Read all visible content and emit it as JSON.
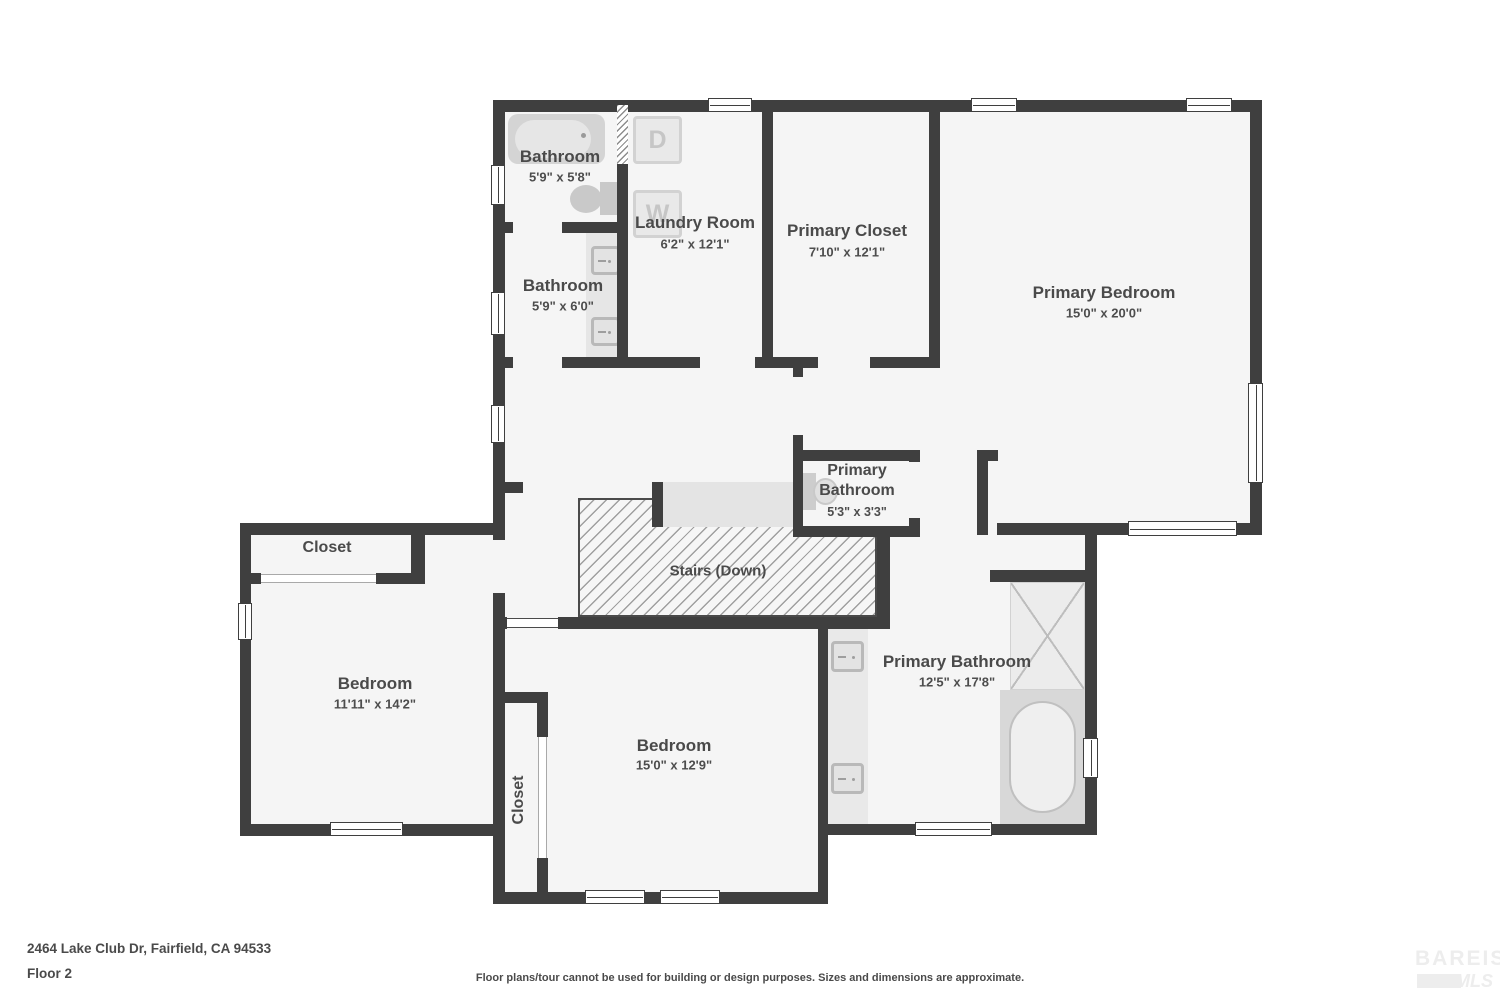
{
  "meta": {
    "address": "2464 Lake Club Dr, Fairfield, CA 94533",
    "floor_label": "Floor 2",
    "disclaimer": "Floor plans/tour cannot be used for building or design purposes. Sizes and dimensions are approximate.",
    "logo": {
      "line1": "BAREIS",
      "reg": "®",
      "line2": "MLS"
    }
  },
  "rooms": {
    "bathroom_top": {
      "name": "Bathroom",
      "dims": "5'9\" x 5'8\""
    },
    "bathroom_mid": {
      "name": "Bathroom",
      "dims": "5'9\" x 6'0\""
    },
    "laundry": {
      "name": "Laundry Room",
      "dims": "6'2\" x 12'1\""
    },
    "primary_closet": {
      "name": "Primary Closet",
      "dims": "7'10\" x 12'1\""
    },
    "primary_bedroom": {
      "name": "Primary Bedroom",
      "dims": "15'0\" x 20'0\""
    },
    "primary_bathroom_small": {
      "name": "Primary Bathroom",
      "dims": "5'3\" x 3'3\""
    },
    "stairs": {
      "name": "Stairs (Down)"
    },
    "closet_left": {
      "name": "Closet"
    },
    "bedroom_left": {
      "name": "Bedroom",
      "dims": "11'11\" x 14'2\""
    },
    "closet_bottom": {
      "name": "Closet"
    },
    "bedroom_bottom": {
      "name": "Bedroom",
      "dims": "15'0\" x 12'9\""
    },
    "primary_bathroom": {
      "name": "Primary Bathroom",
      "dims": "12'5\" x 17'8\""
    }
  },
  "fixtures": {
    "dryer": "D",
    "washer": "W"
  }
}
